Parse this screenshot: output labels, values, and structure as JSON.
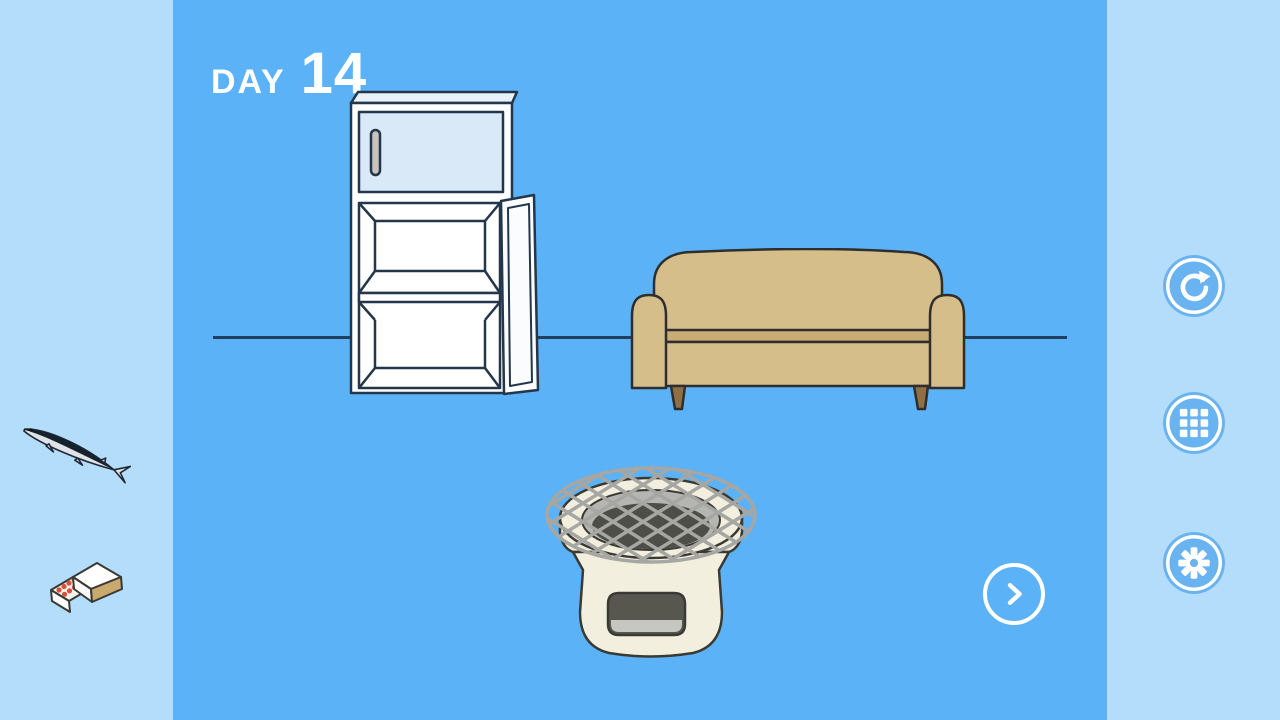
{
  "hud": {
    "day_label": "DAY",
    "day_value": "14"
  },
  "inventory": {
    "items": [
      {
        "id": "fish",
        "label": "fish (sanma)"
      },
      {
        "id": "matchbox",
        "label": "matchbox"
      }
    ]
  },
  "scene": {
    "objects": [
      {
        "id": "refrigerator",
        "state": "door-open"
      },
      {
        "id": "sofa",
        "state": "default"
      },
      {
        "id": "charcoal-grill",
        "state": "default"
      }
    ]
  },
  "controls": {
    "next_button": {
      "icon": "chevron-right-icon"
    },
    "menu_buttons": [
      {
        "id": "retry",
        "icon": "refresh-icon"
      },
      {
        "id": "levels",
        "icon": "grid-icon"
      },
      {
        "id": "settings",
        "icon": "gear-icon"
      }
    ]
  },
  "colors": {
    "panel_bg": "#b4ddfb",
    "stage_bg": "#5cb2f6",
    "button_fill": "#68b3f0",
    "floor_line": "#1e3e62",
    "day_text": "#ffffff",
    "fridge_door": "#d9e9f8",
    "sofa_tan": "#d6be8b",
    "sofa_tan_dark": "#c7ac74",
    "sofa_leg": "#8e7044",
    "grill_cream": "#f3efdf",
    "grill_ring": "#b5b5b1",
    "grill_hole": "#4e4e49",
    "grill_mesh": "#a6a6a2",
    "vent_dark": "#57574f",
    "vent_light": "#c7c7c2",
    "fish_silver": "#dfe3e8",
    "fish_stripe": "#16212e",
    "match_red": "#d9503c",
    "striker_tan": "#c9a96d"
  }
}
